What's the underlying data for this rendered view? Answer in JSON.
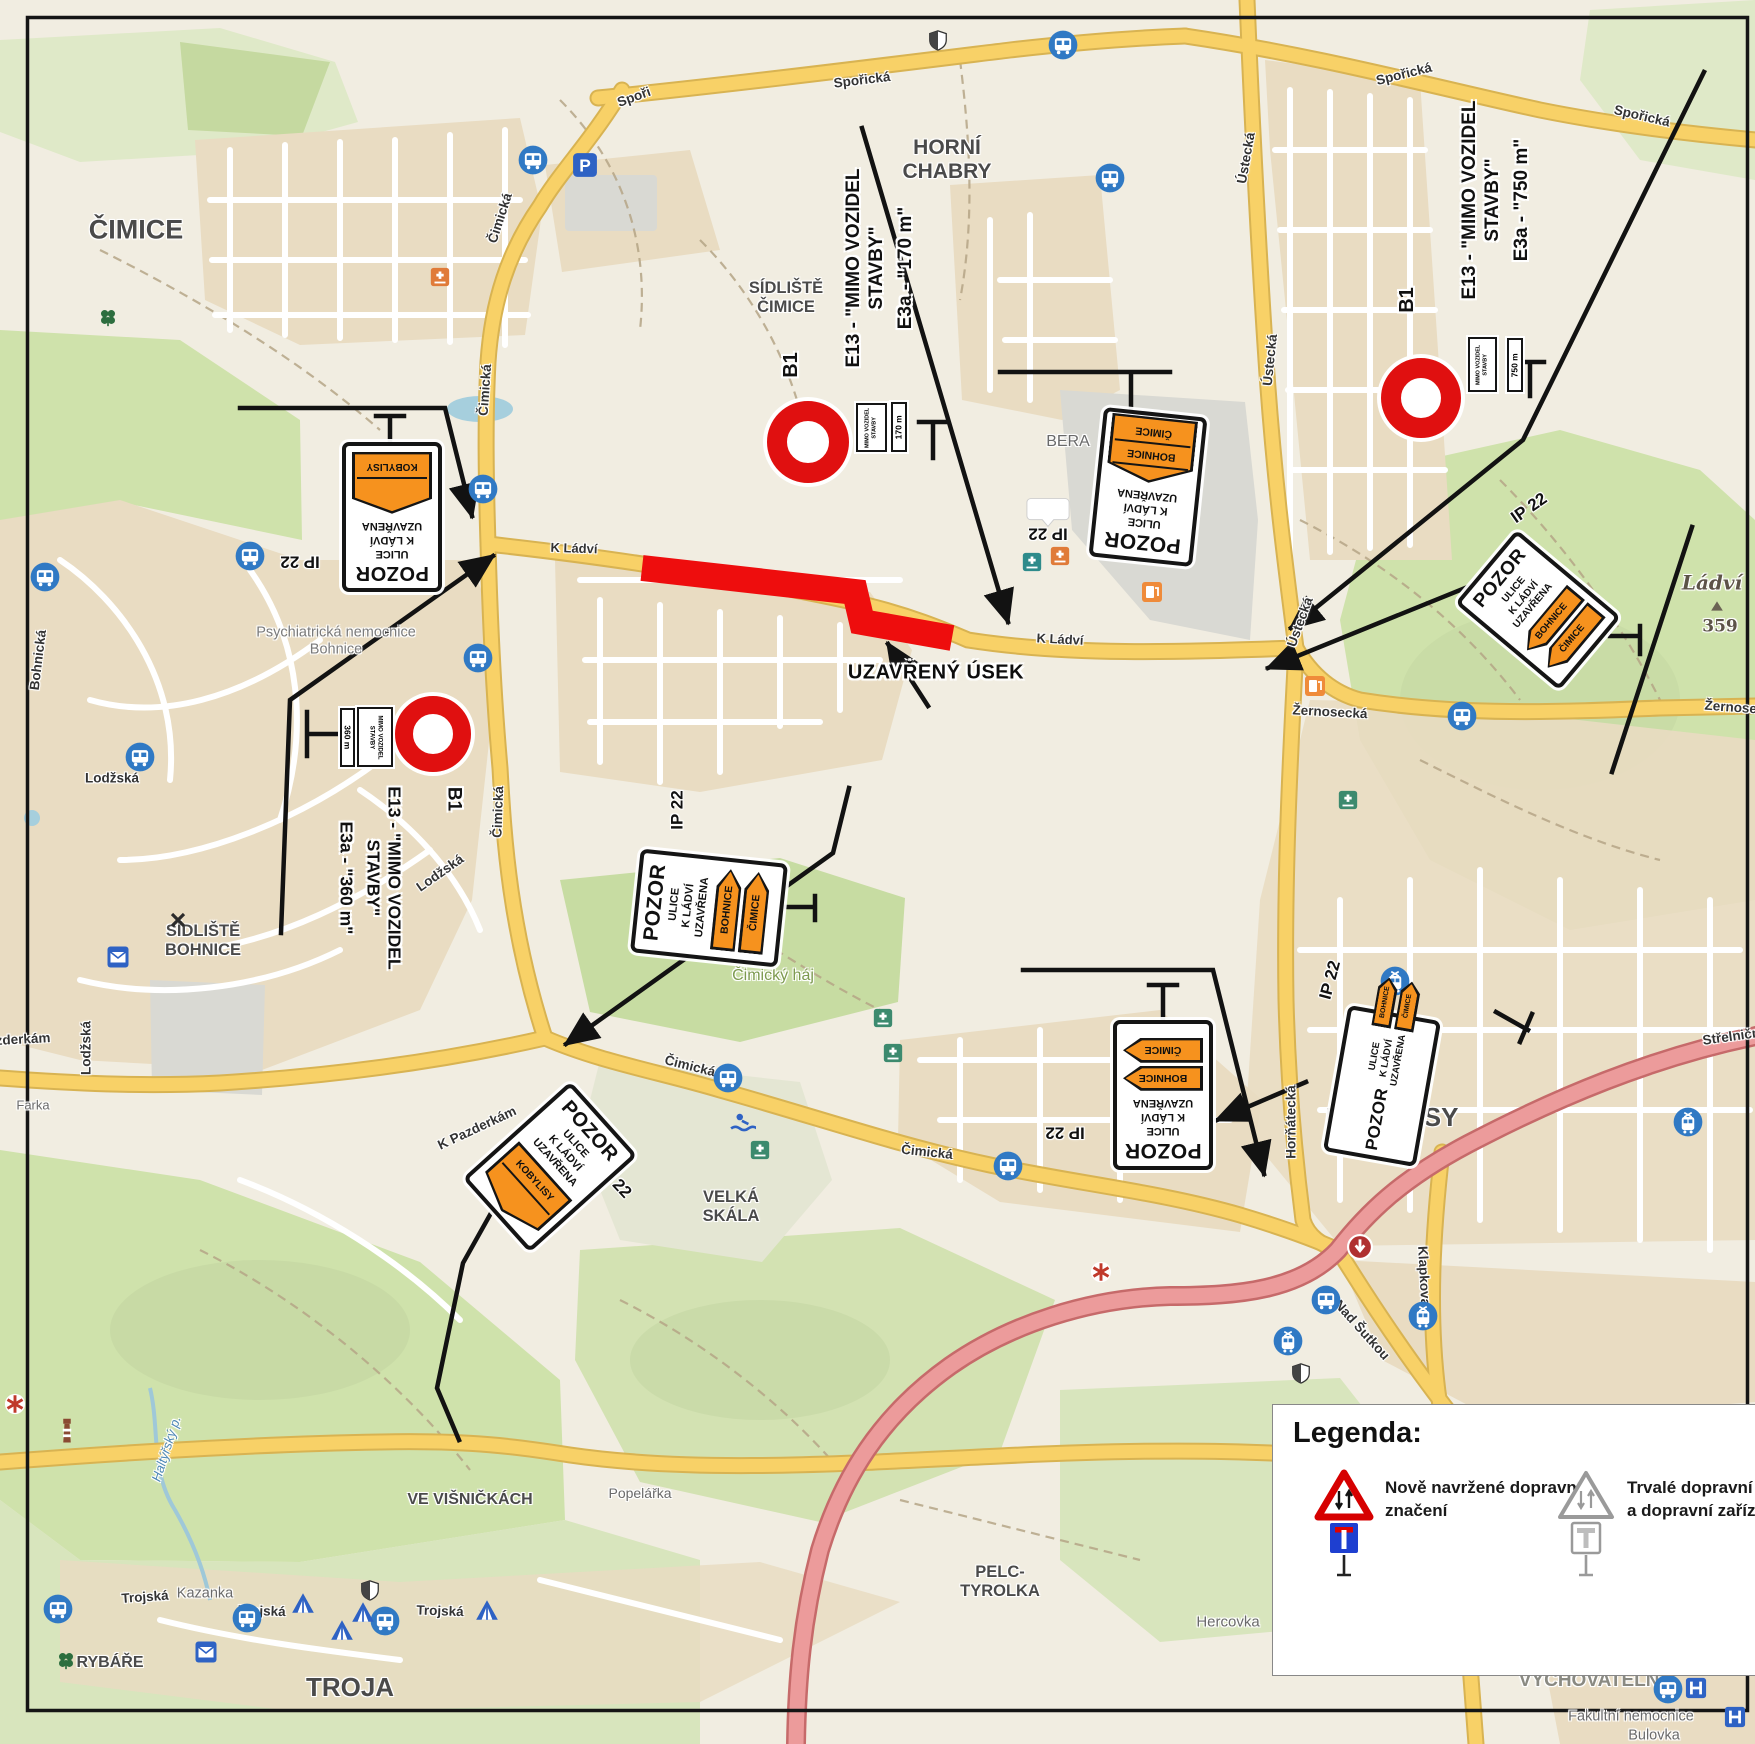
{
  "colors": {
    "map_bg": "#f1ede1",
    "urban": "#e9dcc2",
    "green": "#cfe2ab",
    "green_pale": "#dfe9c8",
    "gray_area": "#d9d9d3",
    "road_yellow": "#f8d167",
    "road_yellow_case": "#d8b352",
    "road_red": "#ec9b9b",
    "road_red_case": "#c66a6a",
    "closure_red": "#ee0d0d",
    "plate_orange": "#f6921e",
    "icon_blue": "#3079c4",
    "frame_black": "#151515",
    "water": "#a6cfdd"
  },
  "annotations": {
    "closed_section_label": "UZAVŘENÝ ÚSEK",
    "ip22": "IP 22"
  },
  "signs": {
    "pozor": {
      "title": "POZOR",
      "line1": "ULICE",
      "line2": "K LÁDVÍ",
      "line3": "UZAVŘENA"
    },
    "plates": {
      "bohnice": "BOHNICE",
      "cimice": "ČIMICE",
      "kobylisy": "KOBYLISY"
    },
    "mimo2": "MIMO VOZIDEL\nSTAVBY",
    "groups": [
      {
        "b1": "B1",
        "e13a": "E13 - \"MIMO VOZIDEL",
        "e13b": "STAVBY\"",
        "e3a": "E3a - \"170 m\"",
        "dist": "170 m"
      },
      {
        "b1": "B1",
        "e13a": "E13 - \"MIMO VOZIDEL",
        "e13b": "STAVBY\"",
        "e3a": "E3a - \"750 m\"",
        "dist": "750 m"
      },
      {
        "b1": "B1",
        "e13a": "E13 - \"MIMO VOZIDEL",
        "e13b": "STAVBY\"",
        "e3a": "E3a - \"360 m\"",
        "dist": "360 m"
      }
    ]
  },
  "legend": {
    "title": "Legenda:",
    "items": [
      {
        "icon": "new-signage",
        "label": "Nově navržené dopravní\nznačení"
      },
      {
        "icon": "permanent-signage",
        "label": "Trvalé dopravní značení\na dopravní zařízení"
      }
    ]
  },
  "map_labels": [
    {
      "id": "cimice",
      "text": "ČIMICE",
      "x": 136,
      "y": 230,
      "s": 27
    },
    {
      "id": "horni-chabry",
      "text": "HORNÍ\nCHABRY",
      "x": 947,
      "y": 160,
      "s": 21
    },
    {
      "id": "sidliste-cimice",
      "text": "SÍDLIŠTĚ\nČIMICE",
      "x": 786,
      "y": 298,
      "s": 16.5
    },
    {
      "id": "sidliste-bohnice",
      "text": "SÍDLIŠTĚ\nBOHNICE",
      "x": 203,
      "y": 941,
      "s": 16.5
    },
    {
      "id": "kobylisy",
      "text": "KOBYLISY",
      "x": 1392,
      "y": 1118,
      "s": 26
    },
    {
      "id": "troja",
      "text": "TROJA",
      "x": 350,
      "y": 1688,
      "s": 26
    },
    {
      "id": "rybare",
      "text": "RYBÁŘE",
      "x": 110,
      "y": 1663,
      "s": 16
    },
    {
      "id": "ve-visnickach",
      "text": "VE VIŠNIČKÁCH",
      "x": 470,
      "y": 1500,
      "s": 16
    },
    {
      "id": "velka-skala",
      "text": "VELKÁ\nSKÁLA",
      "x": 731,
      "y": 1207,
      "s": 16.5
    },
    {
      "id": "pelc-tyrolka",
      "text": "PELC-\nTYROLKA",
      "x": 1000,
      "y": 1582,
      "s": 16.5
    },
    {
      "id": "hercovka",
      "text": "Hercovka",
      "x": 1228,
      "y": 1622,
      "s": 15,
      "c": "#6a6a6a",
      "w": 400
    },
    {
      "id": "kazanka",
      "text": "Kazanka",
      "x": 205,
      "y": 1594,
      "s": 14.5,
      "c": "#6a6a6a",
      "w": 400
    },
    {
      "id": "popelarka",
      "text": "Popelářka",
      "x": 640,
      "y": 1494,
      "s": 14,
      "c": "#6a6a6a",
      "w": 400
    },
    {
      "id": "psychiatricka-nemocnice",
      "text": "Psychiatrická nemocnice\nBohnice",
      "x": 336,
      "y": 641,
      "s": 14.5,
      "c": "#7a7a7a",
      "w": 400
    },
    {
      "id": "vychovatelna",
      "text": "VYCHOVATELNA",
      "x": 1596,
      "y": 1681,
      "s": 19,
      "c": "#8a8a82"
    },
    {
      "id": "fakultni-nemocnice",
      "text": "Fakultní nemocnice",
      "x": 1631,
      "y": 1717,
      "s": 14.5,
      "c": "#6a6a6a",
      "w": 400
    },
    {
      "id": "bulovka",
      "text": "Bulovka",
      "x": 1654,
      "y": 1736,
      "s": 14.5,
      "c": "#6a6a6a",
      "w": 400
    },
    {
      "id": "bera",
      "text": "BERA",
      "x": 1068,
      "y": 442,
      "s": 16,
      "c": "#6a6a6a",
      "w": 400
    },
    {
      "id": "ladvi",
      "text": "Ládví",
      "x": 1712,
      "y": 583,
      "s": 20,
      "c": "#5c5347",
      "f": 1,
      "i": 1,
      "w": 700
    },
    {
      "id": "ladvi-elevation",
      "text": "359",
      "x": 1720,
      "y": 627,
      "s": 17,
      "c": "#5c5347",
      "f": 1
    },
    {
      "id": "haltyrsky-potok",
      "text": "Haltýřský p.",
      "x": 167,
      "y": 1449,
      "r": -72,
      "s": 13,
      "c": "#4d87b5",
      "i": 1,
      "w": 400
    },
    {
      "id": "cimicky-haj",
      "text": "Čimický háj",
      "x": 773,
      "y": 976,
      "s": 16,
      "c": "#7d9a4f",
      "w": 400
    },
    {
      "id": "farka",
      "text": "Farka",
      "x": 33,
      "y": 1106,
      "s": 13,
      "c": "#6a6a6a",
      "w": 400
    },
    {
      "id": "sporicka-1",
      "text": "Spořická",
      "x": 862,
      "y": 80,
      "r": -7,
      "s": 13.5,
      "c": "#333"
    },
    {
      "id": "spori",
      "text": "Spoři",
      "x": 634,
      "y": 97,
      "r": -20,
      "s": 13.5,
      "c": "#333"
    },
    {
      "id": "sporicka-2",
      "text": "Spořická",
      "x": 1404,
      "y": 74,
      "r": -14,
      "s": 13.5,
      "c": "#333"
    },
    {
      "id": "sporicka-3",
      "text": "Spořická",
      "x": 1642,
      "y": 116,
      "r": 13,
      "s": 13.5,
      "c": "#333"
    },
    {
      "id": "cimicka-1",
      "text": "Čimická",
      "x": 500,
      "y": 218,
      "r": -72,
      "s": 13.5,
      "c": "#333"
    },
    {
      "id": "cimicka-2",
      "text": "Čimická",
      "x": 485,
      "y": 390,
      "r": -86,
      "s": 13.5,
      "c": "#333"
    },
    {
      "id": "cimicka-3",
      "text": "Čimická",
      "x": 498,
      "y": 812,
      "r": -88,
      "s": 13.5,
      "c": "#333"
    },
    {
      "id": "cimicka-4",
      "text": "Čimická",
      "x": 690,
      "y": 1066,
      "r": 14,
      "s": 13.5,
      "c": "#333"
    },
    {
      "id": "cimicka-5",
      "text": "Čimická",
      "x": 927,
      "y": 1152,
      "r": 6,
      "s": 13.5,
      "c": "#333"
    },
    {
      "id": "k-ladvi-1",
      "text": "K Ládví",
      "x": 574,
      "y": 549,
      "r": 2,
      "s": 13,
      "c": "#333"
    },
    {
      "id": "k-ladvi-2",
      "text": "K Ládví",
      "x": 1060,
      "y": 640,
      "r": 3,
      "s": 13,
      "c": "#333"
    },
    {
      "id": "ustecka-1",
      "text": "Ústecká",
      "x": 1246,
      "y": 158,
      "r": -80,
      "s": 13.5,
      "c": "#333"
    },
    {
      "id": "ustecka-2",
      "text": "Ústecká",
      "x": 1270,
      "y": 360,
      "r": -84,
      "s": 13.5,
      "c": "#333"
    },
    {
      "id": "ustecka-3",
      "text": "Ústecká",
      "x": 1300,
      "y": 622,
      "r": -70,
      "s": 13.5,
      "c": "#333"
    },
    {
      "id": "zernosecka",
      "text": "Žernosecká",
      "x": 1330,
      "y": 712,
      "r": 3,
      "s": 13.5,
      "c": "#333"
    },
    {
      "id": "zernosecka-2",
      "text": "Žernosecká",
      "x": 1742,
      "y": 708,
      "r": 4,
      "s": 13.5,
      "c": "#333"
    },
    {
      "id": "hornatecka",
      "text": "Horňátecká",
      "x": 1291,
      "y": 1122,
      "r": -90,
      "s": 13.5,
      "c": "#333"
    },
    {
      "id": "k-pazderkam-1",
      "text": "K Pazderkám",
      "x": 477,
      "y": 1128,
      "r": -25,
      "s": 13.5,
      "c": "#333"
    },
    {
      "id": "k-pazderkam-2",
      "text": "K Pazderkám",
      "x": 8,
      "y": 1040,
      "r": -3,
      "s": 13.5,
      "c": "#333"
    },
    {
      "id": "trojska-1",
      "text": "Trojská",
      "x": 145,
      "y": 1597,
      "r": -4,
      "s": 13.5,
      "c": "#333"
    },
    {
      "id": "trojska-2",
      "text": "Trojská",
      "x": 262,
      "y": 1611,
      "r": 2,
      "s": 13.5,
      "c": "#333"
    },
    {
      "id": "trojska-3",
      "text": "Trojská",
      "x": 440,
      "y": 1611,
      "r": 2,
      "s": 13.5,
      "c": "#333"
    },
    {
      "id": "trojska-4",
      "text": "Trojská",
      "x": 1308,
      "y": 1452,
      "r": 2,
      "s": 13.5,
      "c": "#333"
    },
    {
      "id": "nad-sutkou",
      "text": "Nad Šutkou",
      "x": 1362,
      "y": 1330,
      "r": 48,
      "s": 13.5,
      "c": "#333"
    },
    {
      "id": "klapkova",
      "text": "Klapkova",
      "x": 1424,
      "y": 1276,
      "r": 87,
      "s": 13.5,
      "c": "#333"
    },
    {
      "id": "lodzska-1",
      "text": "Lodžská",
      "x": 440,
      "y": 873,
      "r": -35,
      "s": 13.5,
      "c": "#333"
    },
    {
      "id": "lodzska-2",
      "text": "Lodžská",
      "x": 112,
      "y": 778,
      "s": 13.5,
      "c": "#333"
    },
    {
      "id": "lodzska-3",
      "text": "Lodžská",
      "x": 86,
      "y": 1048,
      "r": -90,
      "s": 13.5,
      "c": "#333"
    },
    {
      "id": "bohnicka",
      "text": "Bohnická",
      "x": 38,
      "y": 660,
      "r": -83,
      "s": 13.5,
      "c": "#333"
    },
    {
      "id": "strelnicna",
      "text": "Střelničná",
      "x": 1735,
      "y": 1036,
      "r": -8,
      "s": 13.5,
      "c": "#333"
    },
    {
      "id": "aaa",
      "text": "AAA",
      "x": 1048,
      "y": 510,
      "s": 13,
      "c": "#2255cc",
      "i": 1,
      "u": 1
    },
    {
      "id": "ip22-left",
      "text": "IP 22",
      "x": 300,
      "y": 562,
      "r": 180,
      "s": 17,
      "c": "#111"
    },
    {
      "id": "ip22-center",
      "text": "IP 22",
      "x": 677,
      "y": 810,
      "r": -90,
      "s": 17,
      "c": "#111"
    },
    {
      "id": "ip22-bera",
      "text": "IP 22",
      "x": 1048,
      "y": 534,
      "r": 180,
      "s": 17,
      "c": "#111"
    },
    {
      "id": "ip22-ladvi",
      "text": "IP 22",
      "x": 1529,
      "y": 508,
      "r": -35,
      "s": 17,
      "c": "#111"
    },
    {
      "id": "ip22-hornatecka",
      "text": "IP 22",
      "x": 1065,
      "y": 1133,
      "r": 180,
      "s": 17,
      "c": "#111"
    },
    {
      "id": "ip22-kobylisy",
      "text": "IP 22",
      "x": 1330,
      "y": 980,
      "r": -75,
      "s": 17,
      "c": "#111"
    },
    {
      "id": "ip22-pazderkam",
      "text": "IP 22",
      "x": 615,
      "y": 1181,
      "r": 47,
      "s": 17,
      "c": "#111"
    }
  ],
  "icons": [
    {
      "t": "bus",
      "x": 533,
      "y": 160
    },
    {
      "t": "bus",
      "x": 1063,
      "y": 45
    },
    {
      "t": "bus",
      "x": 1110,
      "y": 178
    },
    {
      "t": "bus",
      "x": 483,
      "y": 489
    },
    {
      "t": "bus",
      "x": 250,
      "y": 556
    },
    {
      "t": "bus",
      "x": 45,
      "y": 577
    },
    {
      "t": "bus",
      "x": 478,
      "y": 658
    },
    {
      "t": "bus",
      "x": 140,
      "y": 757
    },
    {
      "t": "bus",
      "x": 728,
      "y": 1078
    },
    {
      "t": "bus",
      "x": 1008,
      "y": 1166
    },
    {
      "t": "bus",
      "x": 1326,
      "y": 1300
    },
    {
      "t": "bus",
      "x": 1462,
      "y": 716
    },
    {
      "t": "bus",
      "x": 58,
      "y": 1609
    },
    {
      "t": "bus",
      "x": 247,
      "y": 1618
    },
    {
      "t": "bus",
      "x": 385,
      "y": 1621
    },
    {
      "t": "bus",
      "x": 1668,
      "y": 1689
    },
    {
      "t": "tram",
      "x": 1288,
      "y": 1341
    },
    {
      "t": "tram",
      "x": 1423,
      "y": 1316
    },
    {
      "t": "tram",
      "x": 1395,
      "y": 981
    },
    {
      "t": "tram",
      "x": 1688,
      "y": 1122
    },
    {
      "t": "parking",
      "x": 585,
      "y": 165
    },
    {
      "t": "shield",
      "x": 938,
      "y": 40
    },
    {
      "t": "shield",
      "x": 1301,
      "y": 1373
    },
    {
      "t": "shield",
      "x": 370,
      "y": 1590
    },
    {
      "t": "gas",
      "x": 1152,
      "y": 592
    },
    {
      "t": "gas",
      "x": 1315,
      "y": 686
    },
    {
      "t": "pharmacy",
      "x": 883,
      "y": 1018
    },
    {
      "t": "pharmacy",
      "x": 893,
      "y": 1053
    },
    {
      "t": "pharmacy",
      "x": 760,
      "y": 1150
    },
    {
      "t": "pharmacy",
      "x": 1348,
      "y": 800
    },
    {
      "t": "clinic-orange",
      "x": 440,
      "y": 277
    },
    {
      "t": "clinic-orange",
      "x": 1060,
      "y": 556
    },
    {
      "t": "clinic-teal",
      "x": 1032,
      "y": 562
    },
    {
      "t": "tent",
      "x": 303,
      "y": 1603
    },
    {
      "t": "tent",
      "x": 363,
      "y": 1612
    },
    {
      "t": "tent",
      "x": 342,
      "y": 1630
    },
    {
      "t": "tent",
      "x": 487,
      "y": 1610
    },
    {
      "t": "envelope",
      "x": 206,
      "y": 1652
    },
    {
      "t": "envelope",
      "x": 118,
      "y": 957
    },
    {
      "t": "lighthouse",
      "x": 67,
      "y": 1430
    },
    {
      "t": "clover",
      "x": 108,
      "y": 317
    },
    {
      "t": "clover",
      "x": 66,
      "y": 1660
    },
    {
      "t": "swim",
      "x": 743,
      "y": 1123
    },
    {
      "t": "xmark",
      "x": 178,
      "y": 920
    },
    {
      "t": "asterisk",
      "x": 15,
      "y": 1404
    },
    {
      "t": "asterisk",
      "x": 1101,
      "y": 1272
    },
    {
      "t": "aaa-bubble",
      "x": 1048,
      "y": 512
    },
    {
      "t": "roundabout",
      "x": 1360,
      "y": 1247
    },
    {
      "t": "hospital",
      "x": 1696,
      "y": 1688
    },
    {
      "t": "hospital",
      "x": 1735,
      "y": 1717
    },
    {
      "t": "peak",
      "x": 1717,
      "y": 606
    }
  ]
}
